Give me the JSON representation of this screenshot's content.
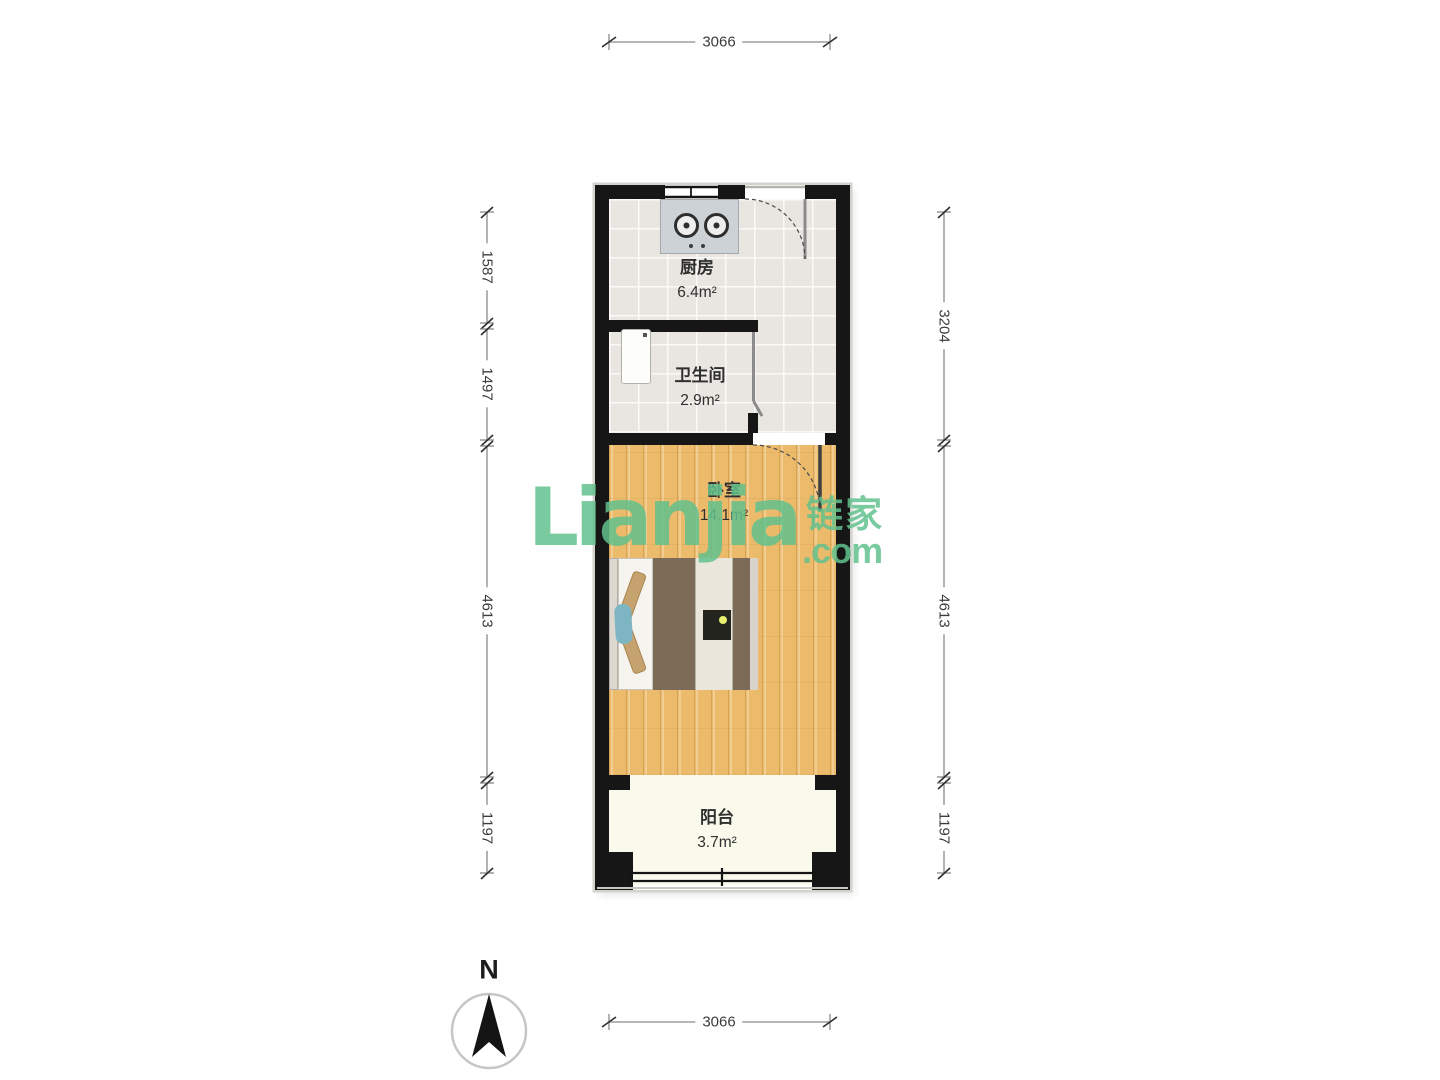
{
  "watermark": {
    "brand": "Lianjia",
    "brand_cn": "链家",
    "brand_suffix": ".com",
    "color": "rgba(97,193,141,0.85)"
  },
  "compass": {
    "label": "N"
  },
  "dimensions": {
    "top": "3066",
    "bottom": "3066",
    "left": [
      "1587",
      "1497",
      "4613",
      "1197"
    ],
    "right": [
      "3204",
      "4613",
      "1197"
    ]
  },
  "rooms": [
    {
      "id": "kitchen",
      "name": "厨房",
      "area": "6.4m²"
    },
    {
      "id": "bathroom",
      "name": "卫生间",
      "area": "2.9m²"
    },
    {
      "id": "bedroom",
      "name": "卧室",
      "area": "14.1m²"
    },
    {
      "id": "balcony",
      "name": "阳台",
      "area": "3.7m²"
    }
  ],
  "colors": {
    "wall": "#161616",
    "wood_floor": "#ecba6b",
    "tile_floor": "#e9e6e1",
    "balcony_floor": "#fafaec",
    "watermark_green": "#61c18d"
  }
}
